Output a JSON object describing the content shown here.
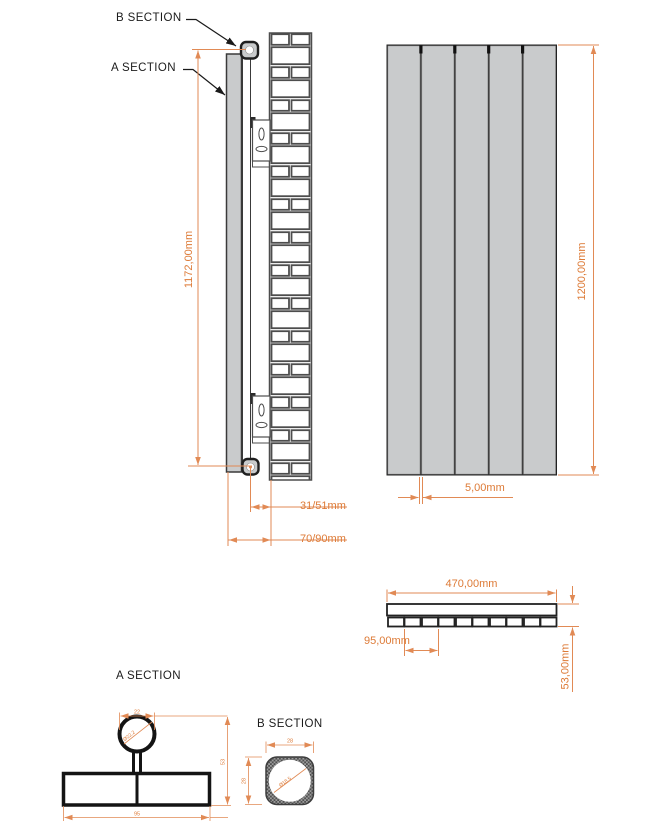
{
  "drawing": {
    "side_view": {
      "b_section_callout": "B SECTION",
      "a_section_callout": "A SECTION",
      "height_dim": "1172,00mm",
      "tube_to_wall_dim": "31/51mm",
      "front_to_wall_dim": "70/90mm"
    },
    "front_view": {
      "height_dim": "1200,00mm",
      "gap_dim": "5,00mm"
    },
    "top_view": {
      "width_dim": "470,00mm",
      "panel_pitch_dim": "95,00mm",
      "depth_dim": "53,00mm"
    },
    "a_section": {
      "title": "A SECTION",
      "tube_width_dim": "22",
      "tube_diameter_dim": "Ø22,2",
      "depth_dim": "53",
      "width_dim": "95"
    },
    "b_section": {
      "title": "B SECTION",
      "width_dim": "28",
      "height_dim": "28",
      "bore_diameter_dim": "Ø18,5"
    },
    "colors": {
      "dimension_accent": "#DD7A36",
      "panel_gray": "#C9CBCC"
    }
  }
}
